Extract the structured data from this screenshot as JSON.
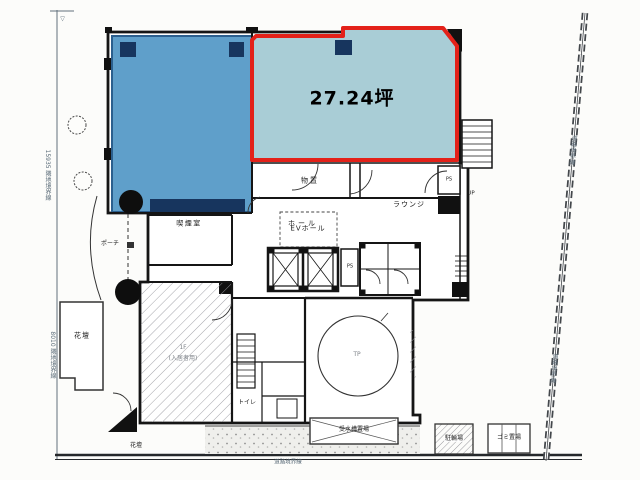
{
  "unit": {
    "area_label": "27.24坪"
  },
  "rooms": {
    "storage": "物置",
    "lounge": "ラウンジ",
    "smoking_room": "喫煙室",
    "hall": "ホール",
    "ev_hall": "EVホール",
    "toilet": "トイレ",
    "porch": "ポーチ",
    "flower_bed": "花壇",
    "flower_bed_2": "花壇",
    "turntable": "TP",
    "machine_room_note_1": "1F",
    "machine_room_note_2": "(入居者用)",
    "water_tank": "受水槽置場",
    "bicycle_parking": "駐輪場",
    "garbage_storage": "ゴミ置場",
    "ps_1": "PS",
    "ps_2": "PS",
    "up": "UP"
  },
  "boundaries": {
    "left_upper": "15935 隣地境界線",
    "left_lower": "8010 隣地境界線",
    "right_upper": "道路境界線",
    "right_lower": "道路境界線",
    "bottom": "道路境界線",
    "corner_mark": "▽"
  },
  "colors": {
    "highlight_border": "#e32119",
    "highlight_fill": "#a9cdd6",
    "occupied_room_fill": "#5f9fca",
    "pillar_navy": "#17355e",
    "line": "#1b1b1b"
  }
}
